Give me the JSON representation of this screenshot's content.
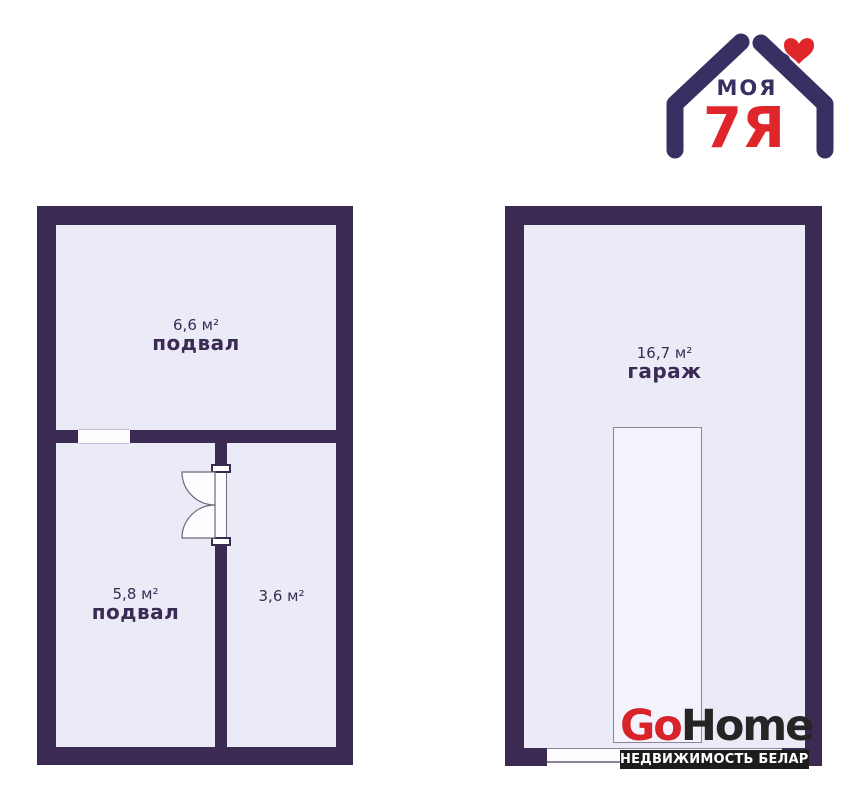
{
  "colors": {
    "page_bg": "#ffffff",
    "wall": "#3b2a51",
    "room_fill": "#ebeaf7",
    "text": "#3b2b54",
    "thin_line": "#8a8698",
    "opening_line": "#c2bdd6",
    "logo_indigo": "#3a2f63",
    "logo_red": "#d8232a",
    "watermark_dark": "#262425",
    "banner_bg": "#1c1c1c",
    "banner_text": "#ffffff"
  },
  "brand_logo": {
    "word_top": "МОЯ",
    "word_main": "7Я"
  },
  "floorplans": {
    "left": {
      "rooms": [
        {
          "area": "6,6 м²",
          "label": "подвал"
        },
        {
          "area": "5,8 м²",
          "label": "подвал"
        },
        {
          "area": "3,6 м²",
          "label": ""
        }
      ]
    },
    "right": {
      "rooms": [
        {
          "area": "16,7 м²",
          "label": "гараж"
        }
      ]
    }
  },
  "watermark": {
    "word_go": "Go",
    "word_home": "Home",
    "tagline": "НЕДВИЖИМОСТЬ БЕЛАРУСИ"
  }
}
